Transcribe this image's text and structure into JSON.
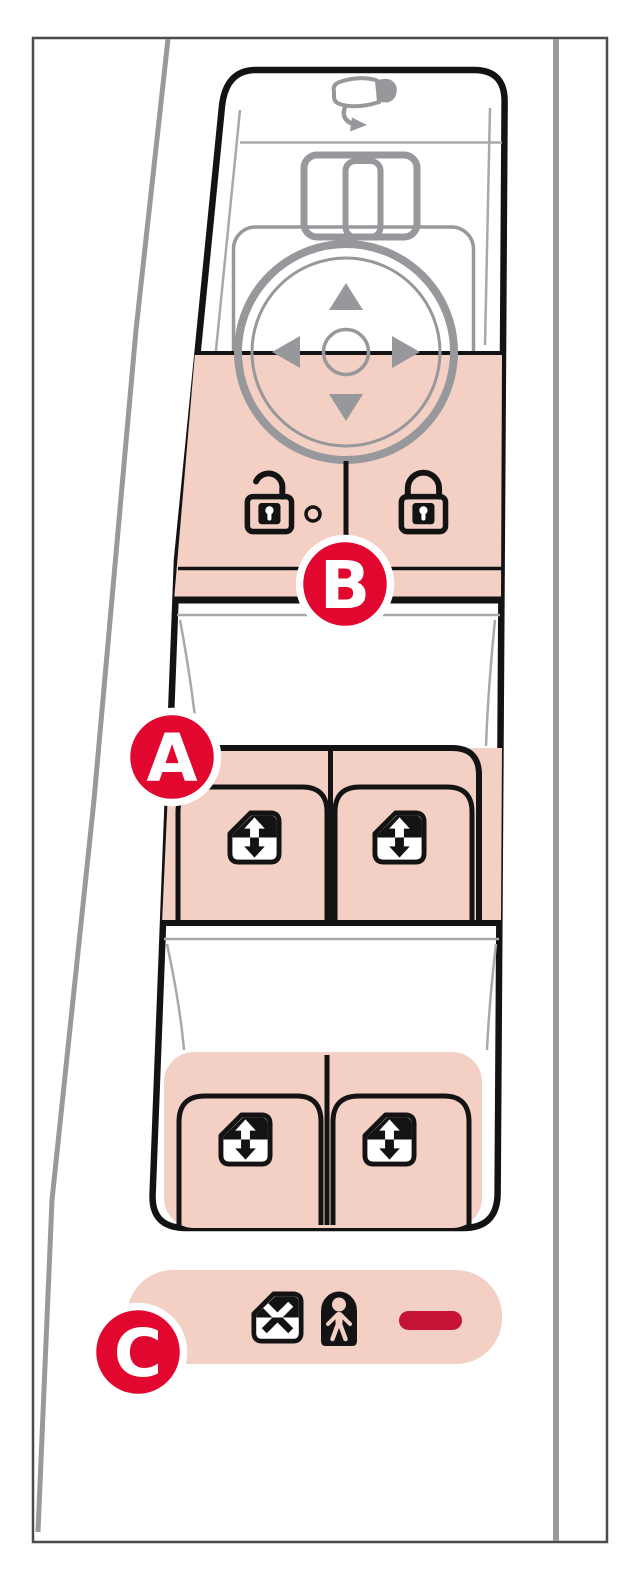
{
  "callouts": {
    "a": {
      "label": "A"
    },
    "b": {
      "label": "B"
    },
    "c": {
      "label": "C"
    }
  },
  "icons": {
    "mirror_adjust": "side-mirror-with-curved-arrow",
    "mirror_selector": "slider-switch",
    "joystick": "four-way-arrow-pad-with-center-button",
    "unlock": "open-padlock",
    "lock": "closed-padlock",
    "lock_indicator": "small-led-dot",
    "window_switch": "window-with-up-down-arrow",
    "window_disable": "window-with-x",
    "child_lock": "child-silhouette-in-lock",
    "disable_indicator": "red-bar"
  },
  "colors": {
    "panel-pink": "#f3cfc4",
    "badge-red": "#e2072e",
    "indicator-red": "#c41334",
    "control-gray": "#97989c",
    "line-gray": "#a8a9ac",
    "outline-black": "#131313",
    "door-gray": "#98999d",
    "frame-gray": "#4a4b4d"
  }
}
